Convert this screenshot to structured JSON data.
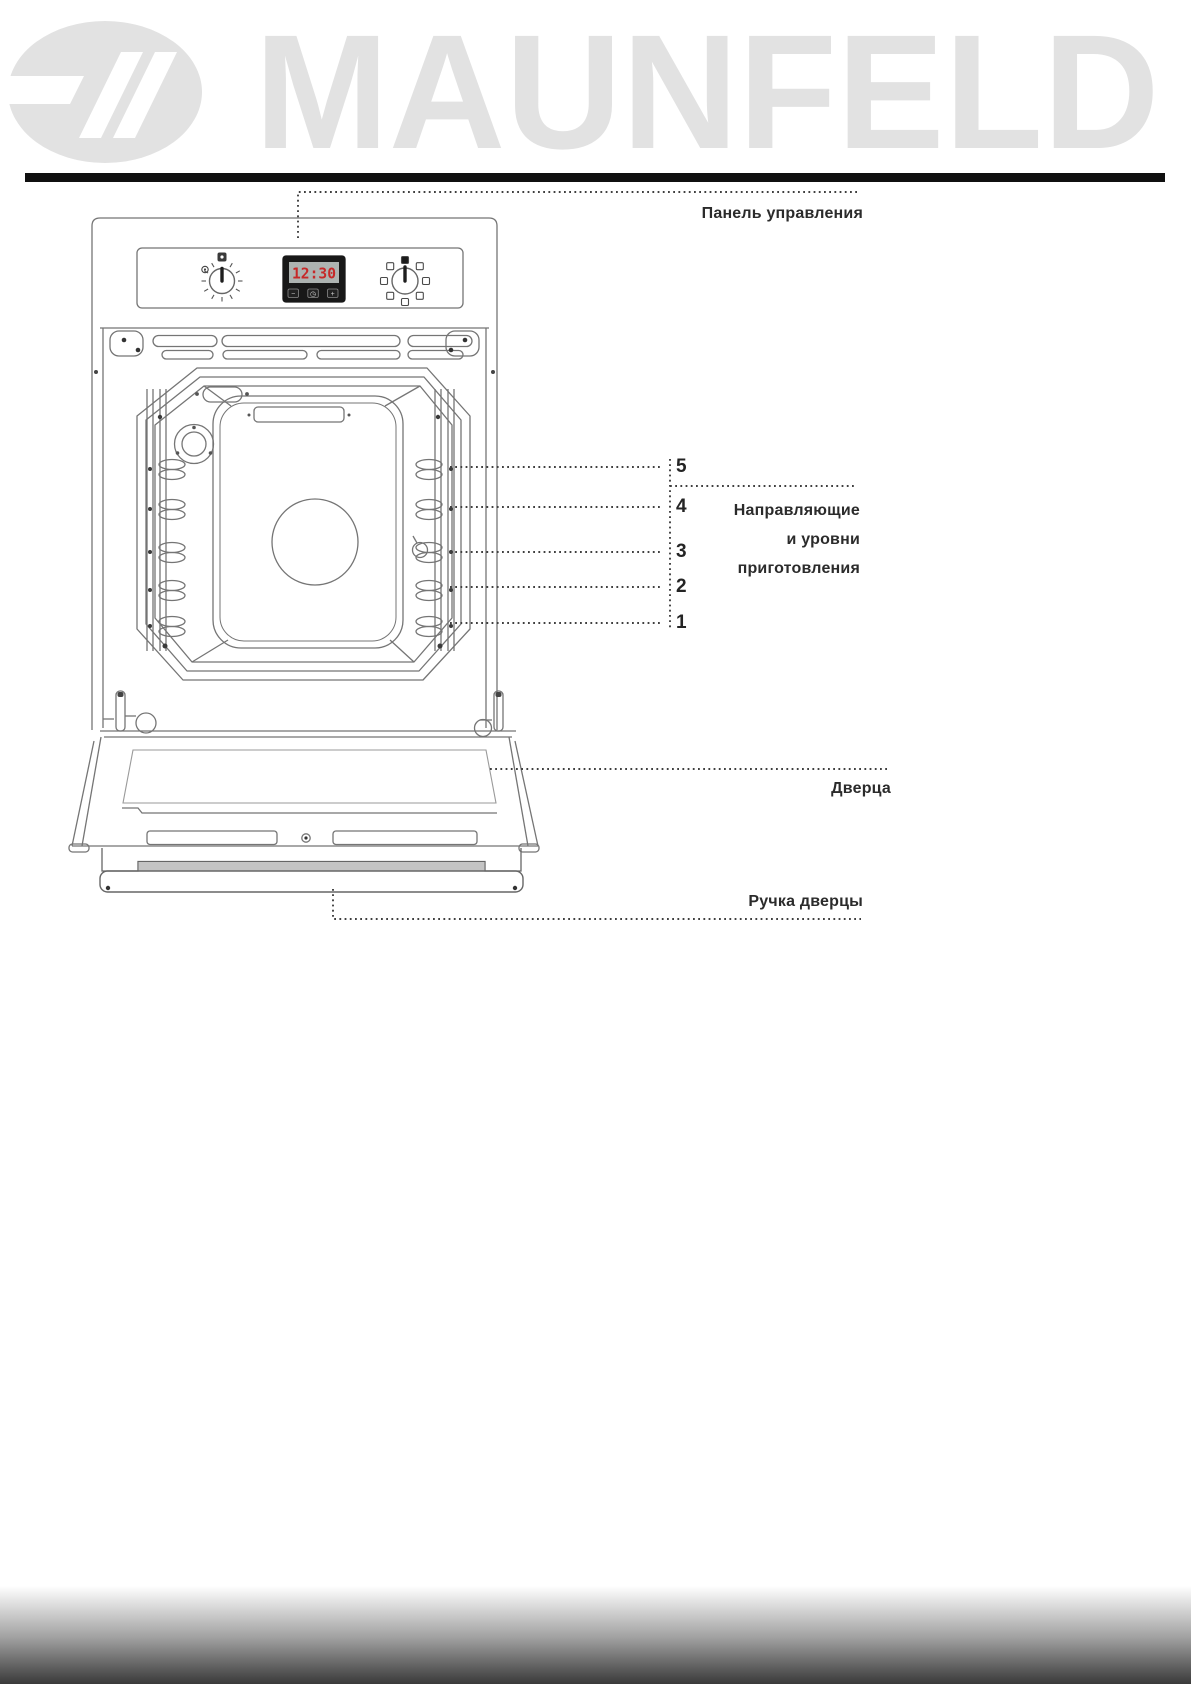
{
  "brand": {
    "logo_text": "MAUNFELD"
  },
  "oven": {
    "display_time": "12:30",
    "display_buttons": [
      "−",
      "◷",
      "+"
    ]
  },
  "annotations": {
    "control_panel": "Панель управления",
    "guides_line1": "Направляющие",
    "guides_line2": "и уровни",
    "guides_line3": "приготовления",
    "door": "Дверца",
    "door_handle": "Ручка дверцы",
    "levels": [
      "5",
      "4",
      "3",
      "2",
      "1"
    ]
  },
  "colors": {
    "logo_gray": "#e2e2e2",
    "rule_black": "#101010",
    "line_art_gray": "#757575",
    "lcd_digits_red": "#c62828",
    "display_bezel": "#181818",
    "label_text": "#2b2b2b",
    "footer_gradient_end": "#3a3a3a"
  }
}
